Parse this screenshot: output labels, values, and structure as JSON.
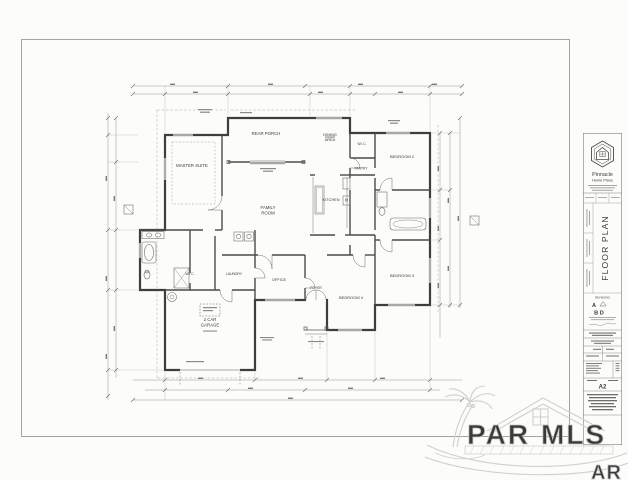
{
  "colors": {
    "paper": "#fcfcfa",
    "frame_line": "#a3a3a0",
    "wall": "#3e3e3e",
    "thin_line": "#777777",
    "dim_line": "#8a8a8a",
    "label_text": "#3a3a3a",
    "watermark": "#cccccc"
  },
  "plan": {
    "rooms": [
      {
        "name": "master-suite",
        "label": "MASTER SUITE"
      },
      {
        "name": "rear-porch",
        "label": "REAR PORCH"
      },
      {
        "name": "dining-area",
        "label": "DINING",
        "label2": "AREA"
      },
      {
        "name": "wic-hall",
        "label": "W.I.C."
      },
      {
        "name": "bedroom-2",
        "label": "BEDROOM 2"
      },
      {
        "name": "pantry",
        "label": "PANTRY"
      },
      {
        "name": "kitchen",
        "label": "KITCHEN"
      },
      {
        "name": "family-room",
        "label": "FAMILY",
        "label2": "ROOM"
      },
      {
        "name": "wic-master",
        "label": "W.I.C."
      },
      {
        "name": "laundry",
        "label": "LAUNDRY"
      },
      {
        "name": "office",
        "label": "OFFICE"
      },
      {
        "name": "foyer",
        "label": "FOYER"
      },
      {
        "name": "bedroom-4",
        "label": "BEDROOM 4"
      },
      {
        "name": "bedroom-3",
        "label": "BEDROOM 3"
      },
      {
        "name": "garage",
        "label": "2 CAR",
        "label2": "GARAGE"
      }
    ]
  },
  "title_block": {
    "company_line1": "Pinnacle",
    "company_line2": "Home Plans",
    "sheet_title": "FLOOR PLAN",
    "revisions_heading": "REVISIONS",
    "rev_a": "A",
    "rev_bd": "B D",
    "sheet_number": "A2"
  },
  "watermark": {
    "word1": "PAR",
    "word2": "MLS",
    "corner": "AR"
  }
}
